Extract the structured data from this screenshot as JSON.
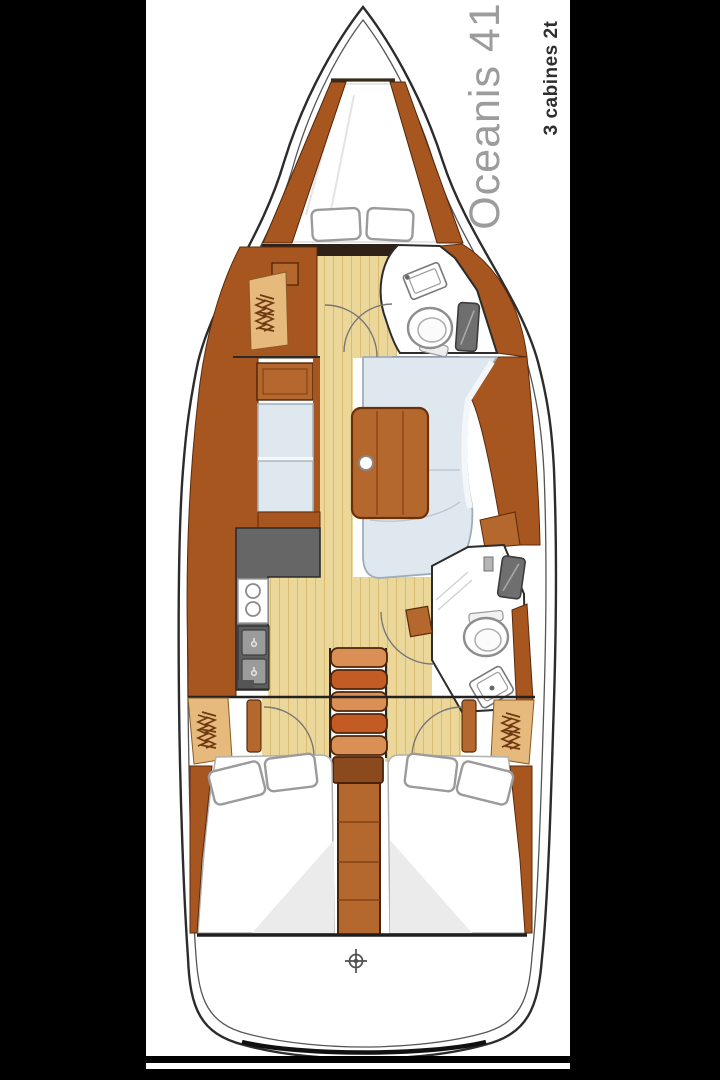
{
  "header": {
    "title": "Oceanis 41",
    "subtitle": "3 cabines 2t"
  },
  "palette": {
    "letterbox": "#000000",
    "paper": "#ffffff",
    "hull_line": "#2c2c2c",
    "wood": "#a8561f",
    "wood_mid": "#b4682e",
    "wood_light": "#cf8a4d",
    "wood_dark": "#55280c",
    "floor": "#ecd79b",
    "floor_line": "#d9bc74",
    "locker": "#e6b97c",
    "steps": "#c35c24",
    "steps_light": "#da9054",
    "cushion": "#dfe7ef",
    "cushion_edge": "#a5b2c0",
    "counter": "#666666",
    "module_gray": "#9b9b9b",
    "glass": "#6f6f6f",
    "shadow": "#ebebeb",
    "title_color": "#9c9c9c",
    "subtitle_color": "#2e2e2e",
    "line_dark": "#1f1f1f"
  },
  "icons": [
    "helm-icon",
    "hanging-locker-icon",
    "stove-burner-icon",
    "faucet-icon",
    "toilet-icon",
    "sink-icon",
    "shower-panel-icon",
    "door-swing-icon"
  ]
}
